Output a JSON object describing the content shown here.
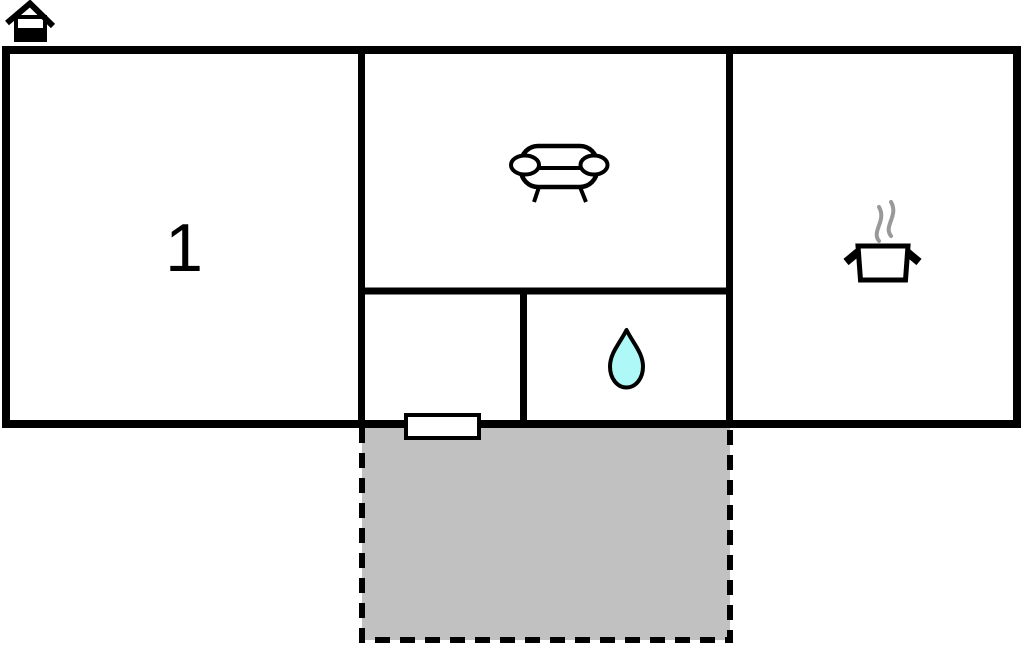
{
  "floorplan": {
    "title": "holiday-home-floor-plan",
    "room1": {
      "label": "1"
    },
    "colors": {
      "wall": "#000000",
      "floor": "#ffffff",
      "terrace_fill": "#c1c1c1",
      "water_drop_fill": "#aef8f8",
      "steam": "#999999",
      "door_fill": "#ffffff"
    },
    "icons": {
      "house": "house-icon",
      "sofa": "sofa-icon",
      "cooking_pot": "cooking-pot-icon",
      "water_drop": "water-drop-icon"
    }
  }
}
